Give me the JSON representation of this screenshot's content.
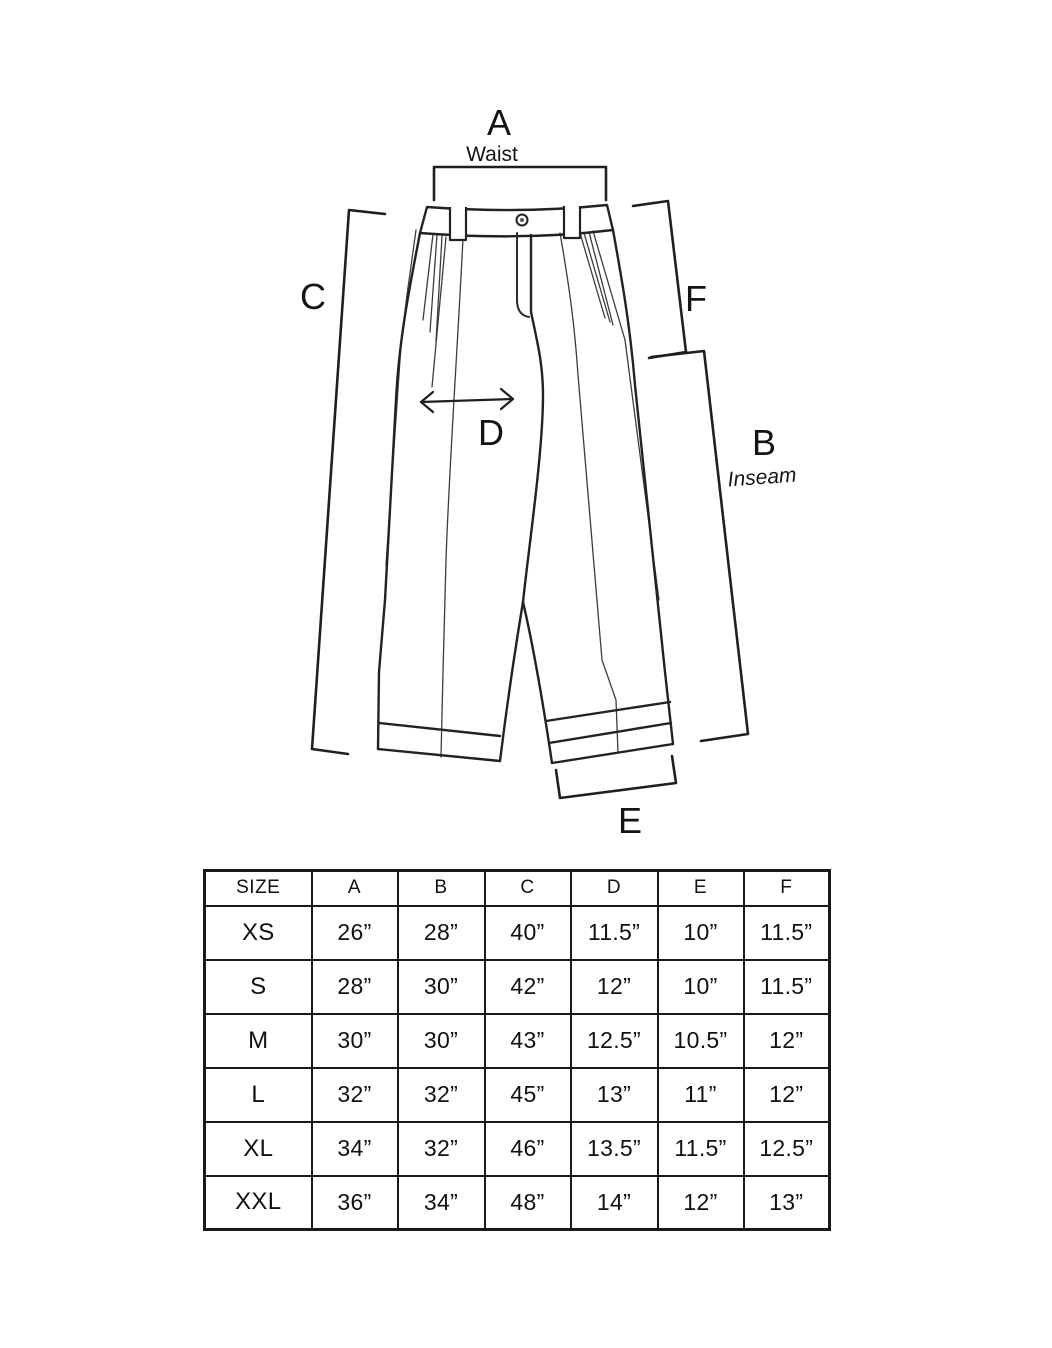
{
  "diagram": {
    "labels": {
      "a": "A",
      "a_sub": "Waist",
      "b": "B",
      "b_sub": "Inseam",
      "c": "C",
      "d": "D",
      "e": "E",
      "f": "F"
    }
  },
  "size_chart": {
    "columns": [
      "SIZE",
      "A",
      "B",
      "C",
      "D",
      "E",
      "F"
    ],
    "rows": [
      [
        "XS",
        "26”",
        "28”",
        "40”",
        "11.5”",
        "10”",
        "11.5”"
      ],
      [
        "S",
        "28”",
        "30”",
        "42”",
        "12”",
        "10”",
        "11.5”"
      ],
      [
        "M",
        "30”",
        "30”",
        "43”",
        "12.5”",
        "10.5”",
        "12”"
      ],
      [
        "L",
        "32”",
        "32”",
        "45”",
        "13”",
        "11”",
        "12”"
      ],
      [
        "XL",
        "34”",
        "32”",
        "46”",
        "13.5”",
        "11.5”",
        "12.5”"
      ],
      [
        "XXL",
        "36”",
        "34”",
        "48”",
        "14”",
        "12”",
        "13”"
      ]
    ]
  }
}
